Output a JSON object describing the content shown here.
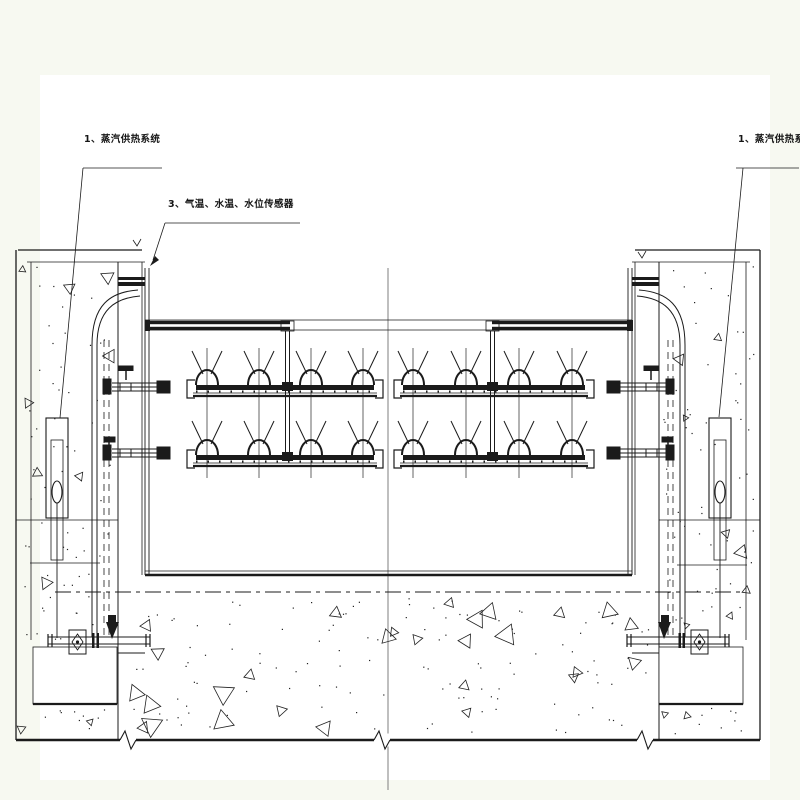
{
  "page": {
    "background_color": "#f7f9f1",
    "sheet_color": "#ffffff",
    "line_color": "#1b1b1b",
    "centerline_color": "#7f7f7f"
  },
  "annotations": {
    "steam_system_left": {
      "label": "1、蒸汽供热系统"
    },
    "sensors": {
      "label": "3、气温、水温、水位传感器"
    },
    "steam_system_right": {
      "label": "1、蒸汽供热系统"
    }
  }
}
